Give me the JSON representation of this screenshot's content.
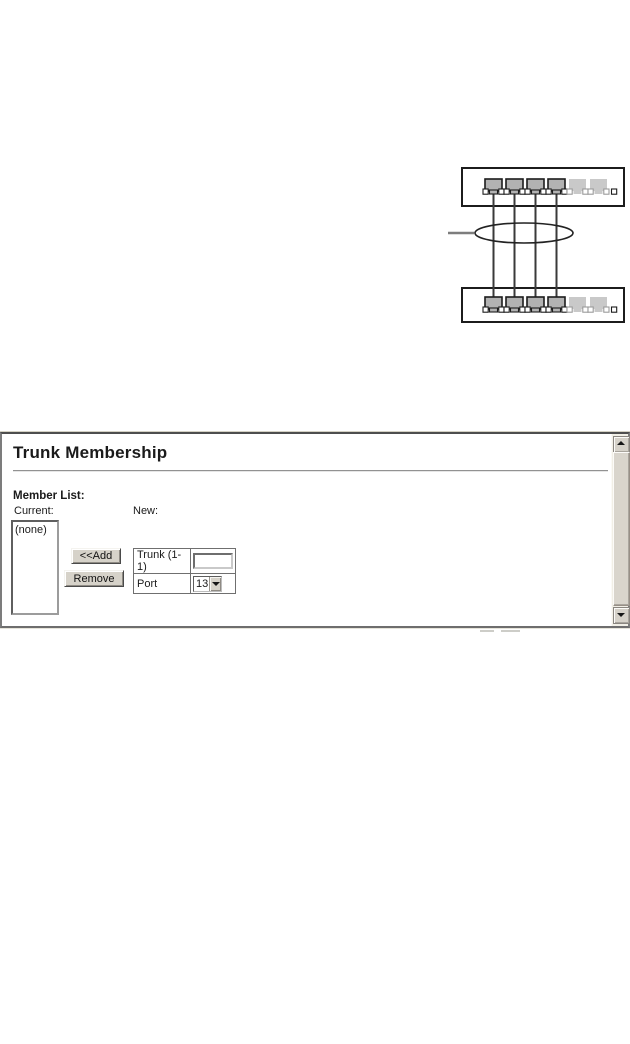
{
  "diagram": {
    "switch_count": 2,
    "ports_per_switch": 6,
    "trunk_link_count": 4,
    "inactive_port_count": 2,
    "colors": {
      "outline": "#1c1c1c",
      "active_port_fill": "#b2b2b2",
      "inactive_port_fill": "#c9c9c9",
      "port_led_fill": "#ffffff",
      "link": "#3a3a3a",
      "pointer_line": "#7d7d7d"
    }
  },
  "panel": {
    "title": "Trunk Membership",
    "member_list_label": "Member List:",
    "current_label": "Current:",
    "new_label": "New:",
    "listbox_items": [
      "(none)"
    ],
    "add_button_label": "<<Add",
    "remove_button_label": "Remove",
    "trunk_row": {
      "label": "Trunk (1-1)",
      "input_value": ""
    },
    "port_row": {
      "label": "Port",
      "selected_value": "13"
    },
    "icons": {
      "scroll_up": "triangle-up",
      "scroll_down": "triangle-down",
      "dropdown": "triangle-down"
    },
    "colors": {
      "button_face": "#d6d2c9",
      "frame_border": "#7c7c7c",
      "scroll_track": "#f1efe6"
    }
  }
}
